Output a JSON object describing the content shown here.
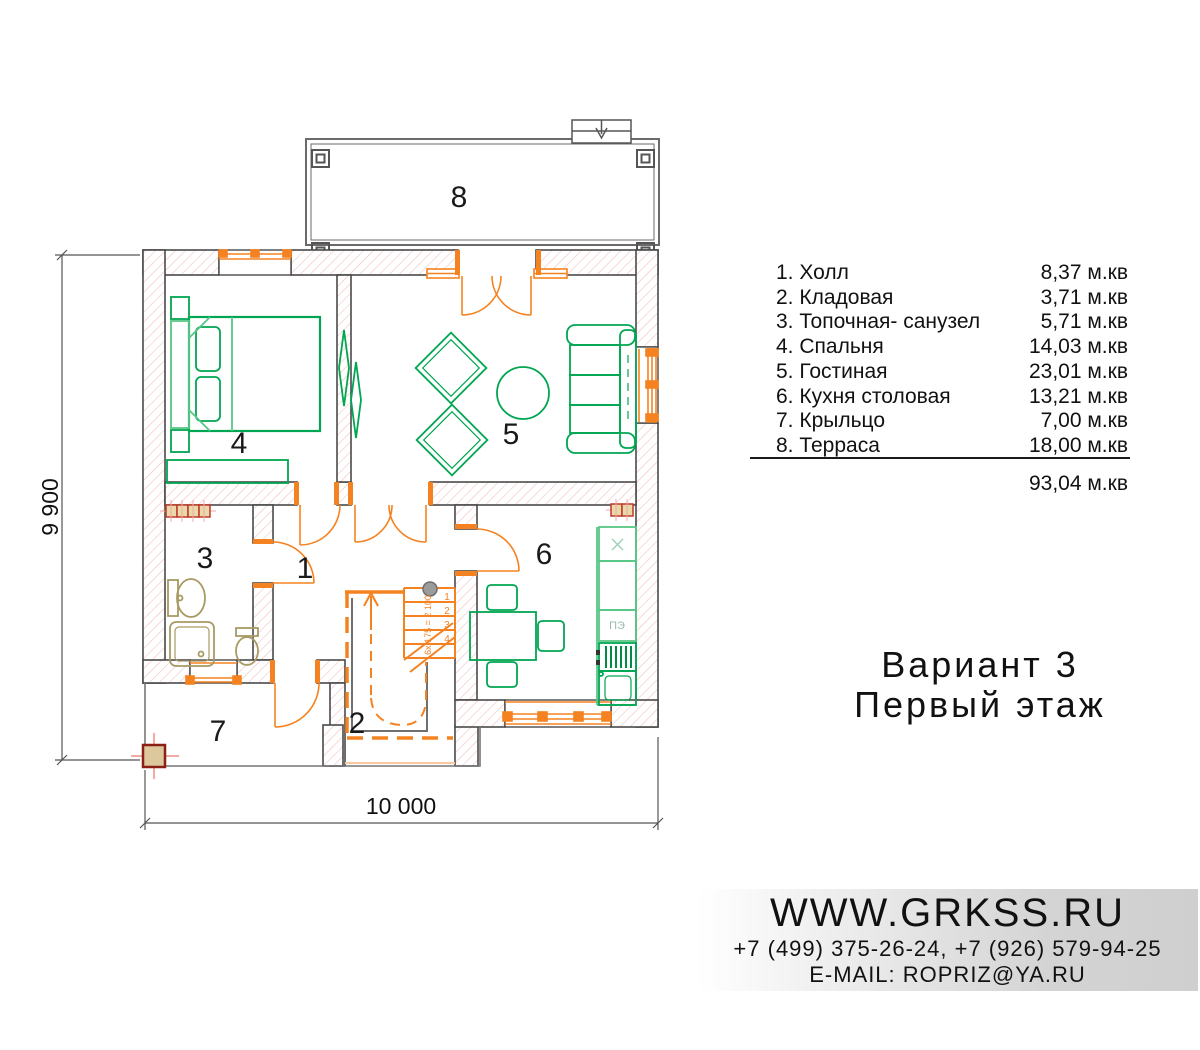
{
  "plan": {
    "dimensions": {
      "height_label": "9 900",
      "width_label": "10 000"
    },
    "room_numbers": [
      "1",
      "2",
      "3",
      "4",
      "5",
      "6",
      "7",
      "8"
    ],
    "stairs": {
      "step_numbers": [
        "1",
        "2",
        "3",
        "4"
      ],
      "note": "6x 175 = 2 100"
    },
    "kitchen": {
      "stove_label": "ПЭ"
    }
  },
  "room_list": {
    "rows": [
      {
        "name": "1. Холл",
        "area": "8,37 м.кв"
      },
      {
        "name": "2. Кладовая",
        "area": "3,71 м.кв"
      },
      {
        "name": "3. Топочная- санузел",
        "area": "5,71 м.кв"
      },
      {
        "name": "4. Спальня",
        "area": "14,03 м.кв"
      },
      {
        "name": "5. Гостиная",
        "area": "23,01 м.кв"
      },
      {
        "name": "6. Кухня столовая",
        "area": "13,21 м.кв"
      },
      {
        "name": "7. Крыльцо",
        "area": "7,00 м.кв"
      },
      {
        "name": "8. Терраса",
        "area": "18,00 м.кв"
      }
    ],
    "total": "93,04 м.кв"
  },
  "title": {
    "line1": "Вариант 3",
    "line2": "Первый этаж"
  },
  "footer": {
    "website": "WWW.GRKSS.RU",
    "phones": "+7 (499) 375-26-24, +7 (926) 579-94-25",
    "email": "E-MAIL: ROPRIZ@YA.RU"
  },
  "colors": {
    "accent_orange": "#f58220",
    "pale_orange": "#f9c9a0",
    "furniture_green": "#00a651",
    "light_green": "#57c785",
    "bath_tan": "#a89a63",
    "radiator_red": "#c0392b",
    "radiator_fill": "#ead9a8",
    "hatch_pink": "#f3bdbd",
    "wall_gray": "#4a4a4a",
    "band_gray": "#cfcfcf"
  }
}
